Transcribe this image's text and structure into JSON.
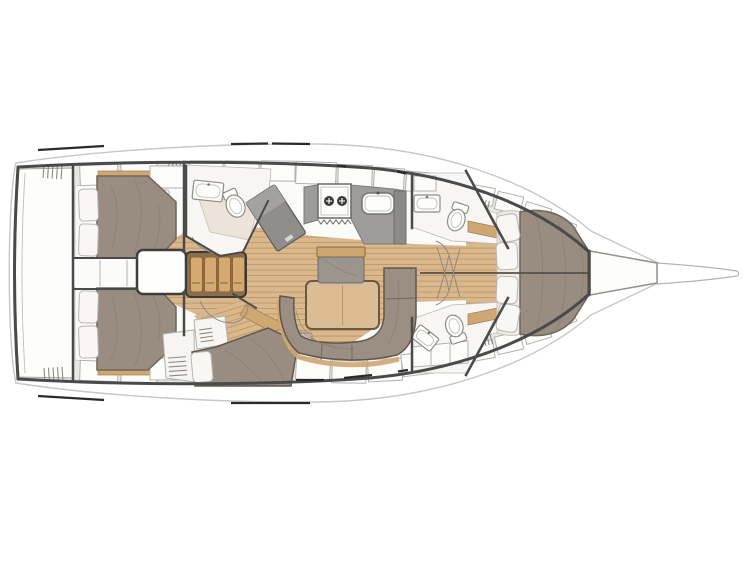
{
  "page": {
    "background": "#ffffff"
  },
  "diagram": {
    "type": "yacht-interior-deck-plan",
    "orientation": "bow-right",
    "visible_text": [],
    "rooms": [
      {
        "id": "stern-platform",
        "label": "stern platform"
      },
      {
        "id": "aft-cabin-port",
        "label": "aft double cabin port"
      },
      {
        "id": "aft-cabin-starboard",
        "label": "aft double cabin starboard"
      },
      {
        "id": "companionway",
        "label": "companionway steps"
      },
      {
        "id": "settee-port",
        "label": "port settee with four cushions"
      },
      {
        "id": "head-aft-port",
        "label": "aft head with sink toilet and shower"
      },
      {
        "id": "nav-station",
        "label": "nav station desk"
      },
      {
        "id": "galley",
        "label": "galley with two-burner stove sink and fridge"
      },
      {
        "id": "saloon",
        "label": "saloon with C-shaped sofa table and seat"
      },
      {
        "id": "berth-midship",
        "label": "midship berth starboard"
      },
      {
        "id": "head-forward-port",
        "label": "forward head port"
      },
      {
        "id": "head-forward-starboard",
        "label": "forward head starboard"
      },
      {
        "id": "forward-cabin",
        "label": "forward owner cabin with double bed and four pillows"
      },
      {
        "id": "anchor-locker",
        "label": "anchor locker"
      },
      {
        "id": "bowsprit",
        "label": "bowsprit"
      }
    ]
  },
  "colors": {
    "background": "#ffffff",
    "hull_outline": "#4a4a4a",
    "sheer_faint": "#c9c7c2",
    "deck": "#e9e7e4",
    "interior_white": "#fbfbfa",
    "locker_white": "#fcfcfb",
    "wood_floor": "#d9b88d",
    "wood_plank_line": "#c19465",
    "wood_trim": "#cfa772",
    "bed_upholstery": "#998c80",
    "sofa_upholstery": "#9b8e82",
    "settee_base": "#8a6f4d",
    "settee_cushion": "#d4aa72",
    "table_wood": "#dcbc90",
    "seat_cushion_gray": "#9b958d",
    "counter_gray": "#9d9c9a",
    "appliance_gray": "#8b8a88",
    "desk_gray": "#8f8e8c",
    "fixture_white": "#fdfdfc",
    "shower_floor": "#ece4d8",
    "headboard_cream": "#efebe4",
    "pillow_white": "#f8f7f4",
    "rail_black": "#2a2a2a",
    "seam_line": "#55504a",
    "side_block": "#c7bcae"
  }
}
